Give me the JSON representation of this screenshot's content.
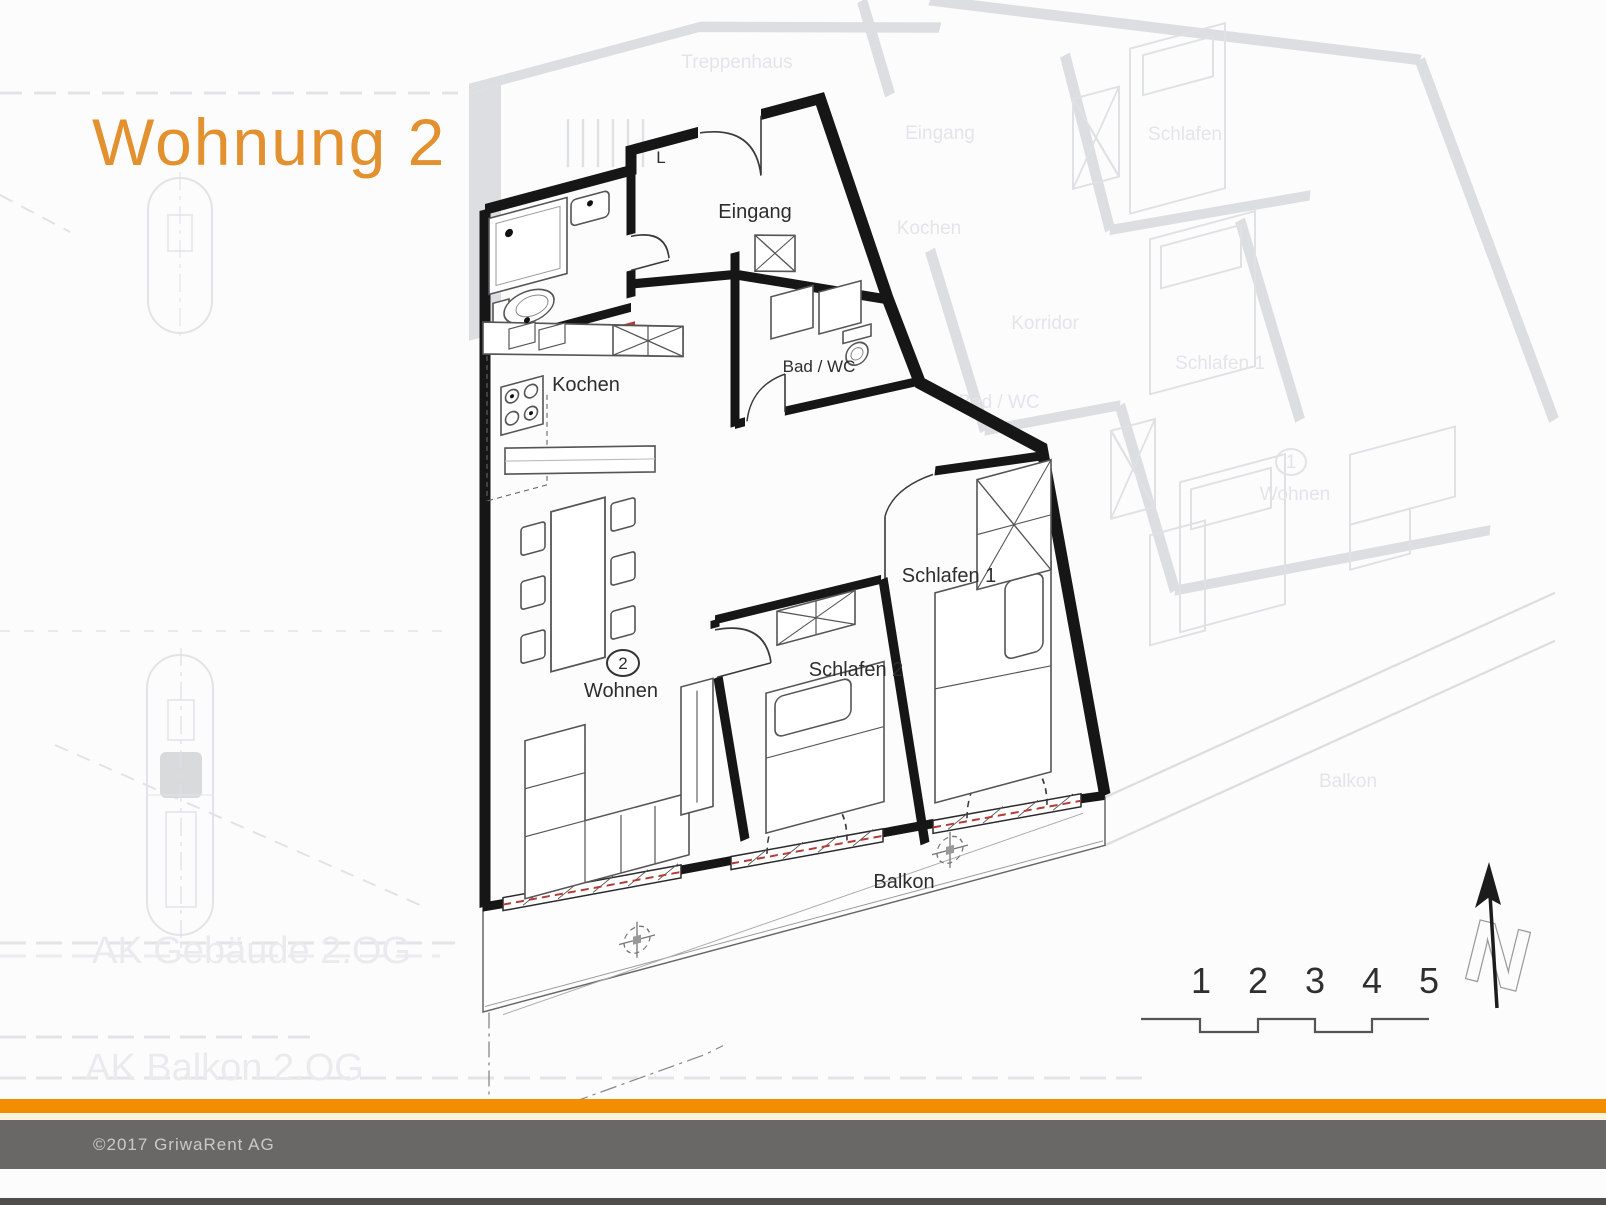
{
  "title": "Wohnung 2",
  "plan": {
    "labels": {
      "vent": "L",
      "entrance": "Eingang",
      "kitchen": "Kochen",
      "bath": "Bad / WC",
      "living_number": "2",
      "living": "Wohnen",
      "bedroom1": "Schlafen 1",
      "bedroom2": "Schlafen 2",
      "balcony": "Balkon"
    }
  },
  "background_plan": {
    "labels": {
      "staircase": "Treppenhaus",
      "entrance": "Eingang",
      "kitchen": "Kochen",
      "corridor": "Korridor",
      "bath": "Bad / WC",
      "bedroom": "Schlafen",
      "bedroom1": "Schlafen 1",
      "living_number": "1",
      "living": "Wohnen",
      "balcony": "Balkon"
    },
    "section_labels": {
      "building": "AK Gebäude 2.OG",
      "balcony": "AK Balkon 2.OG"
    }
  },
  "scale_bar": {
    "labels": [
      "1",
      "2",
      "3",
      "4",
      "5"
    ]
  },
  "compass": {
    "north_label": "N"
  },
  "footer": {
    "copyright": "©2017 GriwaRent AG"
  },
  "colors": {
    "accent_orange": "#E3902E",
    "bar_orange": "#F28E00",
    "footer_gray": "#6A6767",
    "wall_black": "#161616",
    "bg_plan_gray": "#DCDEE1",
    "window_red": "#B23B35"
  }
}
